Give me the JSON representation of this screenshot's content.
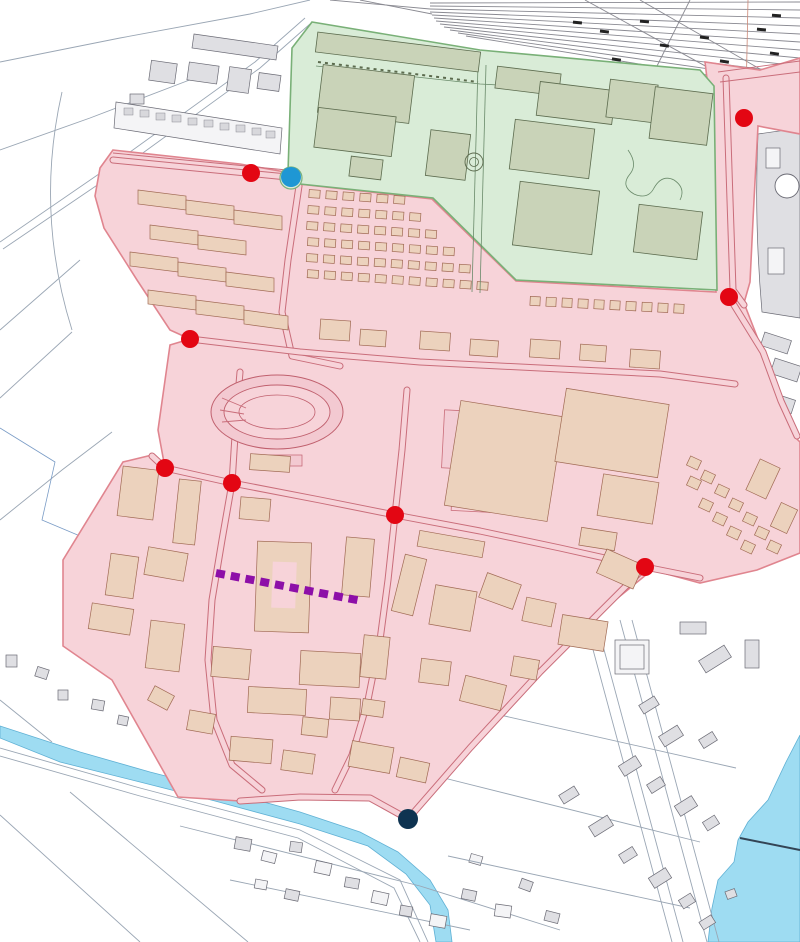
{
  "map": {
    "type": "cadastral-development-plan",
    "canvas": {
      "width": 800,
      "height": 942
    },
    "zones": [
      {
        "id": "red-zone",
        "fill": "#f7d3d9",
        "border": "#e0858f"
      },
      {
        "id": "green-zone",
        "fill": "#d9ecd7",
        "border": "#79b077"
      }
    ],
    "colors": {
      "red_zone_fill": "#f7d3d9",
      "red_zone_border": "#e0858f",
      "green_zone_fill": "#d9ecd7",
      "green_zone_border": "#79b077",
      "building_tan": "#ecd2bd",
      "building_tan_stroke": "#a06a54",
      "building_green": "#c9d3b8",
      "building_green_stroke": "#5c6b4e",
      "building_gray": "#dfdfe3",
      "building_gray_stroke": "#6b6b75",
      "water": "#9edcf2",
      "water_stroke": "#5fb0d4",
      "railway": "#8a8a92",
      "cad_line": "#9aa6b4",
      "cad_blue": "#7a9cc6",
      "road_edge": "#c96d7a",
      "road_core": "#f7d3d9",
      "marker_red": "#e30613",
      "marker_blue": "#1f97d4",
      "marker_navy": "#0e3351",
      "dashed_line": "#8d0fa8"
    },
    "markers": {
      "red_radius": 9,
      "blue_radius": 10,
      "navy_radius": 10,
      "red_junctions": [
        [
          251,
          173
        ],
        [
          744,
          118
        ],
        [
          729,
          297
        ],
        [
          190,
          339
        ],
        [
          165,
          468
        ],
        [
          232,
          483
        ],
        [
          395,
          515
        ],
        [
          645,
          567
        ]
      ],
      "blue_points": [
        [
          291,
          177
        ]
      ],
      "navy_points": [
        [
          408,
          819
        ]
      ]
    },
    "dashed_link": {
      "from": [
        216,
        573
      ],
      "to": [
        362,
        601
      ],
      "width": 8,
      "dash": 9,
      "gap": 6
    }
  }
}
